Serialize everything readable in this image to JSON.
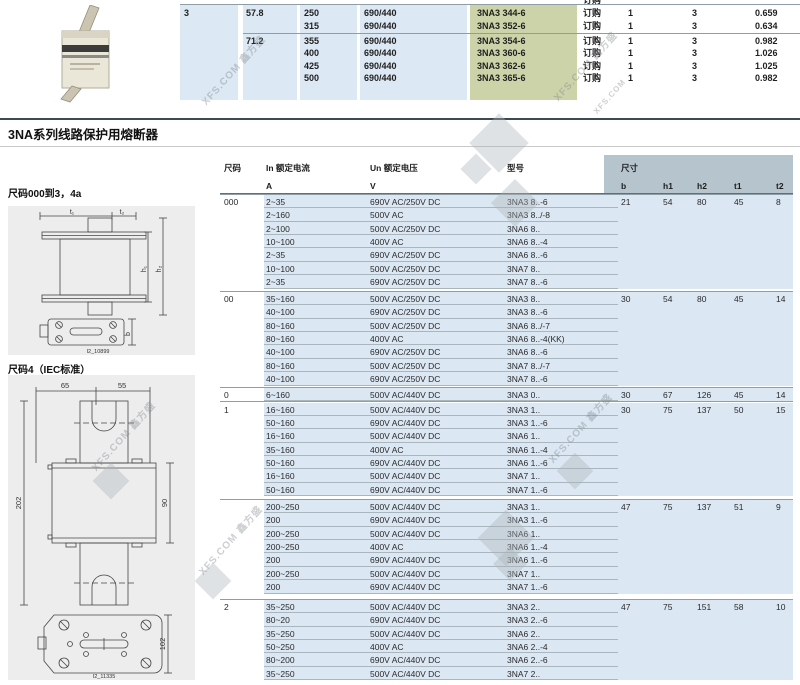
{
  "watermark": {
    "site": "XFS.COM",
    "brand": "鑫方盛"
  },
  "top_table": {
    "partial_header": "订购",
    "rows": [
      {
        "size": "3",
        "i2t": "57.8",
        "in": "250",
        "un": "690/440",
        "model": "3NA3 344-6",
        "order": "订购",
        "pack": "1",
        "unit": "3",
        "weight": "0.659"
      },
      {
        "size": "",
        "i2t": "",
        "in": "315",
        "un": "690/440",
        "model": "3NA3 352-6",
        "order": "订购",
        "pack": "1",
        "unit": "3",
        "weight": "0.634"
      },
      {
        "size": "",
        "i2t": "71.2",
        "in": "355",
        "un": "690/440",
        "model": "3NA3 354-6",
        "order": "订购",
        "pack": "1",
        "unit": "3",
        "weight": "0.982"
      },
      {
        "size": "",
        "i2t": "",
        "in": "400",
        "un": "690/440",
        "model": "3NA3 360-6",
        "order": "订购",
        "pack": "1",
        "unit": "3",
        "weight": "1.026"
      },
      {
        "size": "",
        "i2t": "",
        "in": "425",
        "un": "690/440",
        "model": "3NA3 362-6",
        "order": "订购",
        "pack": "1",
        "unit": "3",
        "weight": "1.025"
      },
      {
        "size": "",
        "i2t": "",
        "in": "500",
        "un": "690/440",
        "model": "3NA3 365-6",
        "order": "订购",
        "pack": "1",
        "unit": "3",
        "weight": "0.982"
      }
    ]
  },
  "section_title": "3NA系列线路保护用熔断器",
  "left_panel": {
    "label_top": "尺码000到3，4a",
    "label_bottom": "尺码4（IEC标准）",
    "fig1_caption": "I2_10899",
    "fig2_caption": "I2_11335",
    "fig1_dims": {
      "t1": "t₁",
      "t2": "t₂",
      "h1": "h₁",
      "h2": "h₂",
      "b": "b"
    },
    "fig2_dims": {
      "w1": "65",
      "w2": "55",
      "h_total": "202",
      "h_body": "90",
      "h_plate": "102"
    }
  },
  "main_table": {
    "headers": {
      "size": "尺码",
      "in": "In 额定电流",
      "in_unit": "A",
      "un": "Un 额定电压",
      "un_unit": "V",
      "model": "型号",
      "dim": "尺寸",
      "b": "b",
      "h1": "h1",
      "h2": "h2",
      "t1": "t1",
      "t2": "t2"
    },
    "groups": [
      {
        "size": "000",
        "dims": [
          "21",
          "54",
          "80",
          "45",
          "8"
        ],
        "rows": [
          [
            "2~35",
            "690V AC/250V DC",
            "3NA3 8..-6"
          ],
          [
            "2~160",
            "500V AC",
            "3NA3 8../-8"
          ],
          [
            "2~100",
            "500V AC/250V DC",
            "3NA6 8.."
          ],
          [
            "10~100",
            "400V AC",
            "3NA6 8..-4"
          ],
          [
            "2~35",
            "690V AC/250V DC",
            "3NA6 8..-6"
          ],
          [
            "10~100",
            "500V AC/250V DC",
            "3NA7 8.."
          ],
          [
            "2~35",
            "690V AC/250V DC",
            "3NA7 8..-6"
          ]
        ]
      },
      {
        "size": "00",
        "dims": [
          "30",
          "54",
          "80",
          "45",
          "14"
        ],
        "rows": [
          [
            "35~160",
            "500V AC/250V DC",
            "3NA3 8.."
          ],
          [
            "40~100",
            "690V AC/250V DC",
            "3NA3 8..-6"
          ],
          [
            "80~160",
            "500V AC/250V DC",
            "3NA6 8../-7"
          ],
          [
            "80~160",
            "400V AC",
            "3NA6 8..-4(KK)"
          ],
          [
            "40~100",
            "690V AC/250V DC",
            "3NA6 8..-6"
          ],
          [
            "80~160",
            "500V AC/250V DC",
            "3NA7 8../-7"
          ],
          [
            "40~100",
            "690V AC/250V DC",
            "3NA7 8..-6"
          ]
        ]
      },
      {
        "size": "0",
        "dims": [
          "30",
          "67",
          "126",
          "45",
          "14"
        ],
        "rows": [
          [
            "6~160",
            "500V AC/440V DC",
            "3NA3 0.."
          ]
        ]
      },
      {
        "size": "1",
        "dims": [
          "30",
          "75",
          "137",
          "50",
          "15"
        ],
        "rows": [
          [
            "16~160",
            "500V AC/440V DC",
            "3NA3 1.."
          ],
          [
            "50~160",
            "690V AC/440V DC",
            "3NA3 1..-6"
          ],
          [
            "16~160",
            "500V AC/440V DC",
            "3NA6 1.."
          ],
          [
            "35~160",
            "400V AC",
            "3NA6 1..-4"
          ],
          [
            "50~160",
            "690V AC/440V DC",
            "3NA6 1..-6"
          ],
          [
            "16~160",
            "500V AC/440V DC",
            "3NA7 1.."
          ],
          [
            "50~160",
            "690V AC/440V DC",
            "3NA7 1..-6"
          ]
        ]
      },
      {
        "size": "",
        "dims": [
          "47",
          "75",
          "137",
          "51",
          "9"
        ],
        "rows": [
          [
            "200~250",
            "500V AC/440V DC",
            "3NA3 1.."
          ],
          [
            "200",
            "690V AC/440V DC",
            "3NA3 1..-6"
          ],
          [
            "200~250",
            "500V AC/440V DC",
            "3NA6 1.."
          ],
          [
            "200~250",
            "400V AC",
            "3NA6 1..-4"
          ],
          [
            "200",
            "690V AC/440V DC",
            "3NA6 1..-6"
          ],
          [
            "200~250",
            "500V AC/440V DC",
            "3NA7 1.."
          ],
          [
            "200",
            "690V AC/440V DC",
            "3NA7 1..-6"
          ]
        ]
      },
      {
        "size": "2",
        "dims": [
          "47",
          "75",
          "151",
          "58",
          "10"
        ],
        "rows": [
          [
            "35~250",
            "500V AC/440V DC",
            "3NA3 2.."
          ],
          [
            "80~20",
            "690V AC/440V DC",
            "3NA3 2..-6"
          ],
          [
            "35~250",
            "500V AC/440V DC",
            "3NA6 2.."
          ],
          [
            "50~250",
            "400V AC",
            "3NA6 2..-4"
          ],
          [
            "80~200",
            "690V AC/440V DC",
            "3NA6 2..-6"
          ],
          [
            "35~250",
            "500V AC/440V DC",
            "3NA7 2.."
          ]
        ]
      }
    ]
  }
}
